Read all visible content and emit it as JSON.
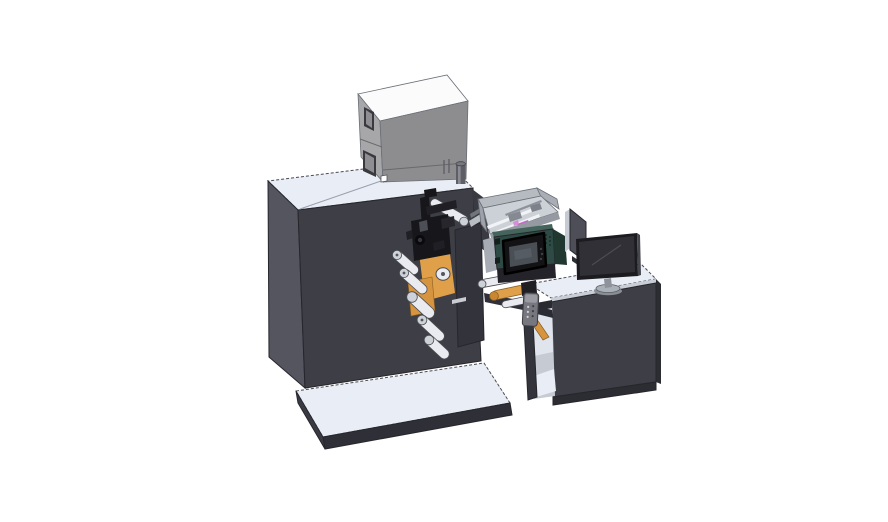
{
  "scene": {
    "type": "3d-cad-render",
    "subject": "label printing machine line with unwind station, print engine, feed tray, control box and operator desk with monitor",
    "background": "#ffffff"
  },
  "colors": {
    "bg": "#ffffff",
    "machine_top": "#e9edf6",
    "machine_left": "#555560",
    "machine_front": "#3e3e46",
    "box_top": "#fbfbfc",
    "box_left": "#a7a7aa",
    "box_front": "#8d8d90",
    "window_frame": "#3a3a3e",
    "window_inner": "#8f8f93",
    "cylinder_body": "#5e5e66",
    "cylinder_hi": "#8b8b93",
    "platform_top": "#e9edf6",
    "platform_front": "#2f2f38",
    "platform_left": "#3a3a44",
    "platform_right": "#2b2b32",
    "desk_top": "#e9edf6",
    "desk_edge": "#c9cdd6",
    "desk_front": "#3e3e47",
    "desk_skirt": "#2c2c33",
    "desk_frame": "#34343d",
    "shelf_base": "#c6cad3",
    "shelf_back": "#e0e4ec",
    "shelf_floor": "#e9edf5",
    "station_plate": "#33333c",
    "orange": "#e0a04a",
    "orange_low": "#d6943f",
    "orange_dark": "#c9872f",
    "roller_white": "#e9ebf0",
    "roller_cap": "#cdd1d8",
    "mech_black": "#17171b",
    "mech_mid": "#1f1f25",
    "web_band": "#b9bec5",
    "beam_dark": "#30303a",
    "teal": "#2d4b44",
    "teal_top": "#45655c",
    "teal_dark": "#203830",
    "teal_cap": "#a7acb4",
    "drawer_dark": "#232329",
    "tray_wall": "#b6bbc2",
    "tray_wall2": "#a9aeb6",
    "tray_interior": "#ccd1d8",
    "tray_rail": "#f1f3f6",
    "tray_lip": "#959aa2",
    "magenta": "#c464c9",
    "magenta_dark": "#8d3c93",
    "panel_black": "#131316",
    "screen_gray": "#4a4f55",
    "screen_hi": "#565c63",
    "divider_face": "#4e4e58",
    "divider_edge": "#c6cad2",
    "monitor_bezel": "#1c1c20",
    "monitor_screen": "#303036",
    "stand": "#aab0b8",
    "pendant": "#77777f",
    "pendant_top": "#9a9aa2",
    "bracket": "#1f1f24",
    "filler_dark": "#3a3a42"
  },
  "components": {
    "main_machine": "main machine cabinet",
    "control_box": "electrical control box",
    "exhaust_cylinder": "exhaust cylinder",
    "unwind_station": "unwind roller station",
    "base_platform": "base platform",
    "web_path": "web / label path rollers",
    "feed_tray": "open feed tray",
    "print_engine": "print engine with control screen",
    "divider_panel": "side divider panel",
    "operator_desk": "operator desk",
    "monitor": "desktop monitor",
    "pendant_control": "hanging pendant control"
  }
}
